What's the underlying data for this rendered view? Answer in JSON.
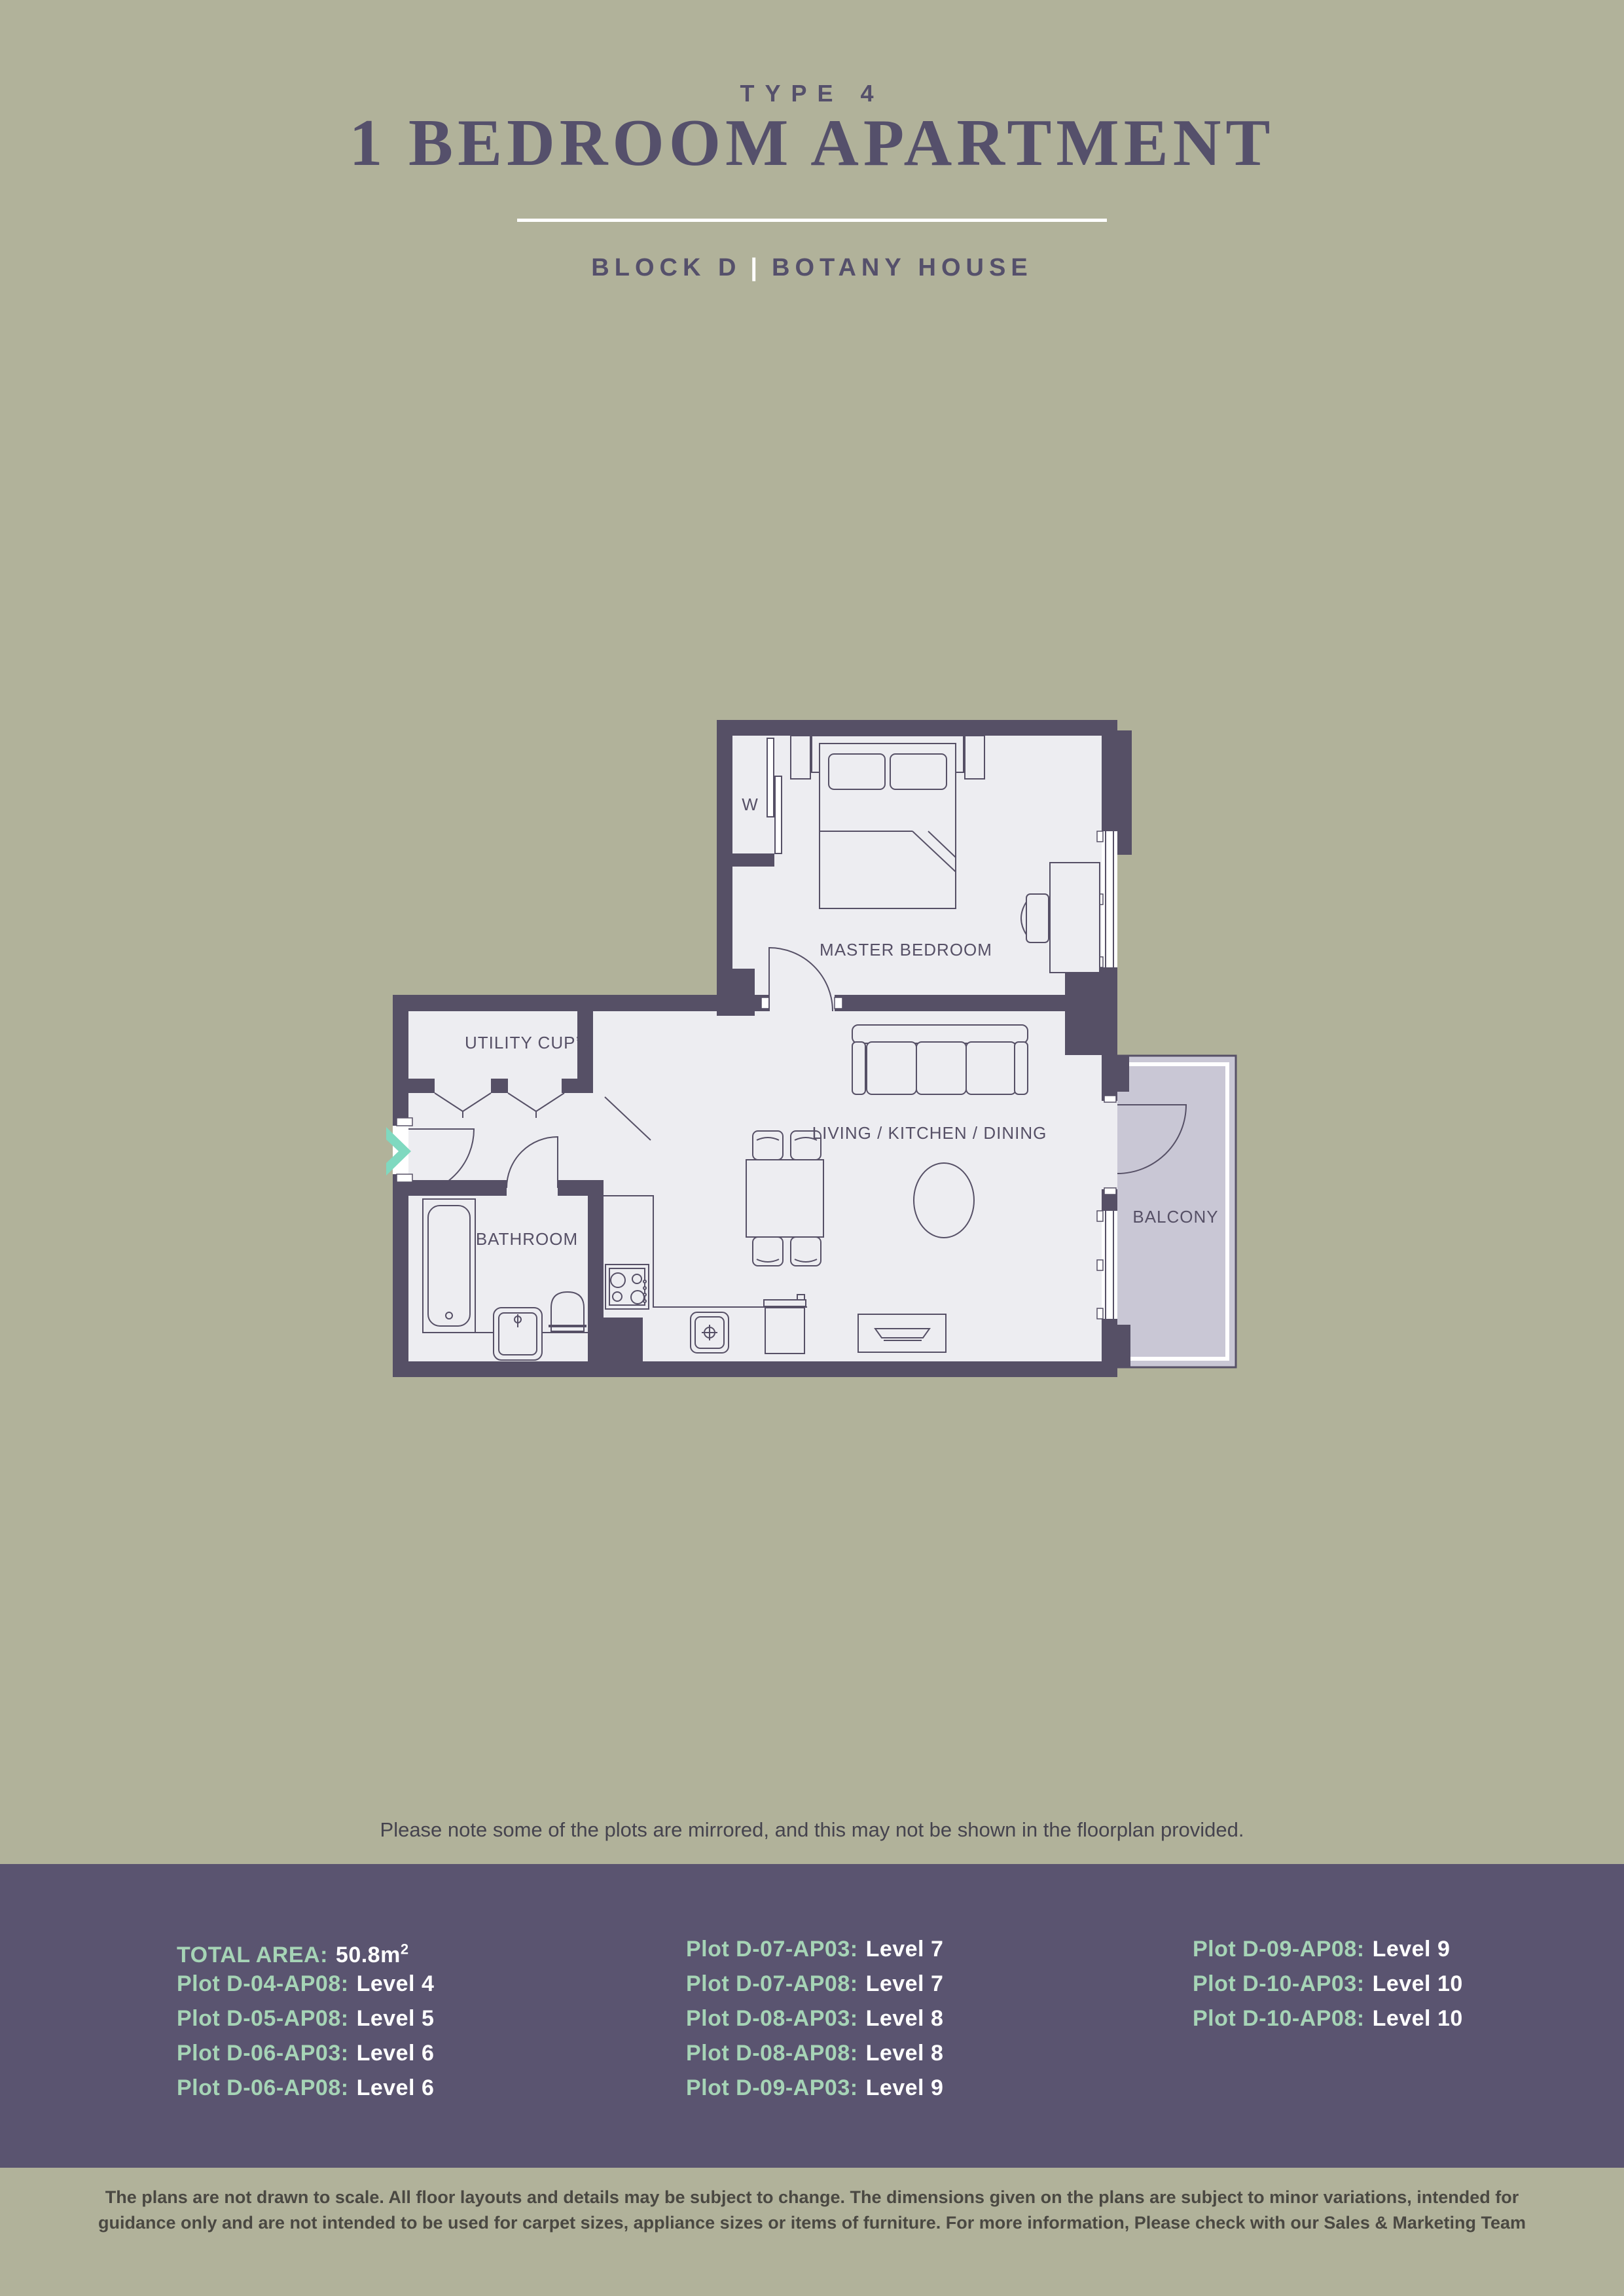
{
  "header": {
    "type_label": "TYPE 4",
    "title": "1 BEDROOM APARTMENT",
    "block": "BLOCK D",
    "separator": "|",
    "house": "BOTANY HOUSE"
  },
  "floorplan": {
    "labels": {
      "wardrobe": "W",
      "master_bedroom": "MASTER BEDROOM",
      "utility": "UTILITY CUP’D",
      "bathroom": "BATHROOM",
      "living": "LIVING / KITCHEN / DINING",
      "balcony": "BALCONY"
    },
    "colors": {
      "wall": "#565066",
      "floor": "#ededf1",
      "balcony_floor": "#c9c7d5",
      "line": "#565066",
      "entry_arrow": "#7fd9c0"
    }
  },
  "note": "Please note some of the plots are mirrored, and this may not be shown in the floorplan provided.",
  "footer": {
    "bg": "#5a5470",
    "label_color": "#a6d4b6",
    "value_color": "#ffffff",
    "total_area": {
      "label": "TOTAL AREA:",
      "value": "50.8m",
      "sup": "2"
    },
    "col1": [
      {
        "plot": "Plot D-04-AP08:",
        "level": "Level 4"
      },
      {
        "plot": "Plot D-05-AP08:",
        "level": "Level 5"
      },
      {
        "plot": "Plot D-06-AP03:",
        "level": "Level 6"
      },
      {
        "plot": "Plot D-06-AP08:",
        "level": "Level 6"
      }
    ],
    "col2": [
      {
        "plot": "Plot D-07-AP03:",
        "level": "Level 7"
      },
      {
        "plot": "Plot D-07-AP08:",
        "level": "Level 7"
      },
      {
        "plot": "Plot D-08-AP03:",
        "level": "Level 8"
      },
      {
        "plot": "Plot D-08-AP08:",
        "level": "Level 8"
      },
      {
        "plot": "Plot D-09-AP03:",
        "level": "Level 9"
      }
    ],
    "col3": [
      {
        "plot": "Plot D-09-AP08:",
        "level": "Level 9"
      },
      {
        "plot": "Plot D-10-AP03:",
        "level": "Level 10"
      },
      {
        "plot": "Plot D-10-AP08:",
        "level": "Level 10"
      }
    ]
  },
  "disclaimer": {
    "line1": "The plans are not drawn to scale. All floor layouts and details may be subject to change. The dimensions given on the plans are subject to minor variations, intended for",
    "line2": "guidance only and are not intended to be used for carpet sizes, appliance sizes or items of furniture. For more information, Please check with our Sales & Marketing Team"
  }
}
